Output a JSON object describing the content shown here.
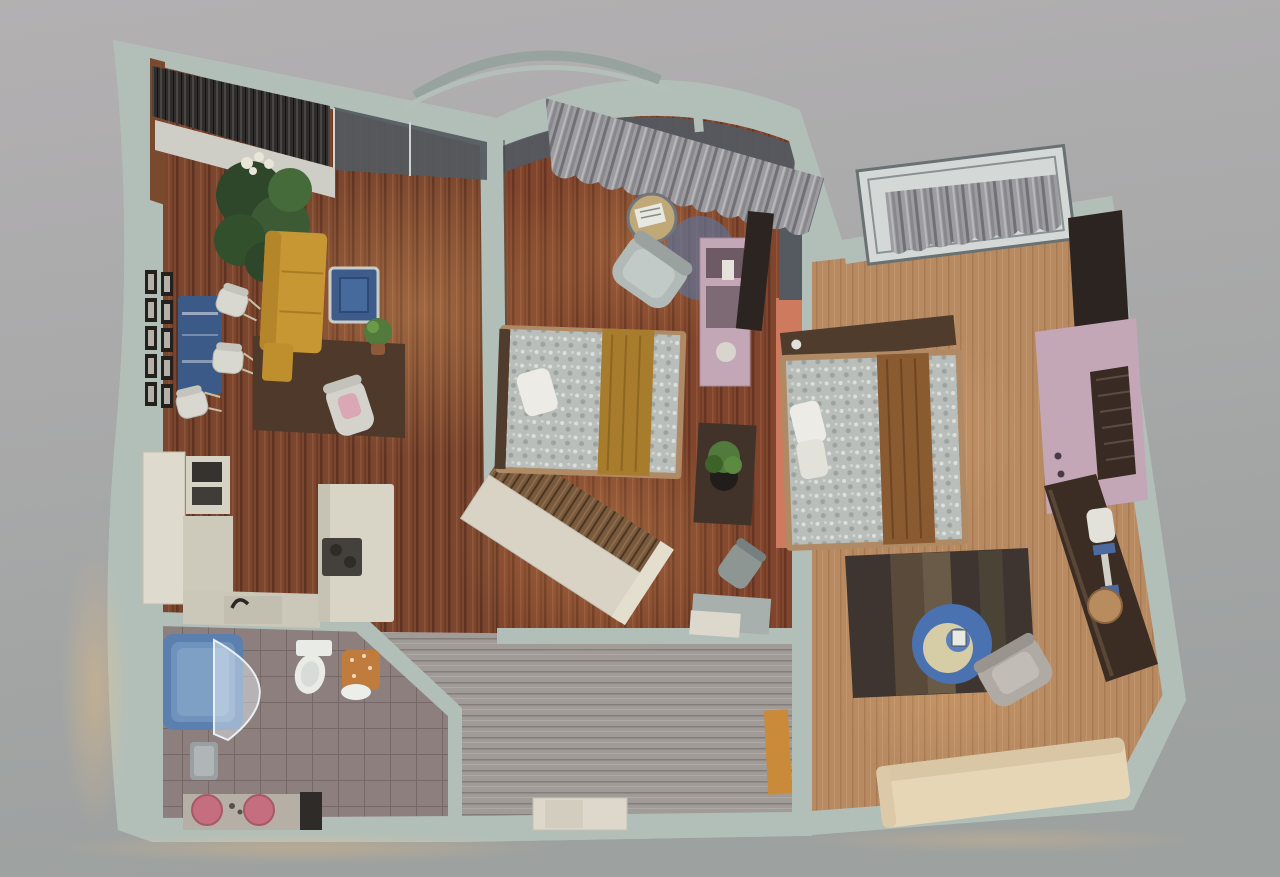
{
  "scene": {
    "kind": "3d-floorplan-top-view",
    "rooms": [
      {
        "id": "living-room",
        "label": "Living room",
        "furniture": [
          "corner window with blinds",
          "window sideboard",
          "large green plant",
          "picture frame wall grid",
          "blue wall table",
          "three white chairs",
          "yellow sofa",
          "dark area rug",
          "blue coffee table",
          "small floor plant",
          "white armchair with pink cushion"
        ]
      },
      {
        "id": "kitchen",
        "label": "Kitchen",
        "furniture": [
          "tall cabinet",
          "oven stack",
          "L-shaped counter",
          "sink with faucet",
          "island with dark cooktop"
        ]
      },
      {
        "id": "bathroom",
        "label": "Bathroom",
        "furniture": [
          "blue bathtub",
          "curved glass screen",
          "toilet",
          "orange laundry basket",
          "towel",
          "vanity with two pink sinks"
        ]
      },
      {
        "id": "entry-hall",
        "label": "Entry hall",
        "furniture": [
          "angled wood-slat wardrobe",
          "white console",
          "amber open door"
        ]
      },
      {
        "id": "bedroom-center",
        "label": "Center bedroom",
        "furniture": [
          "gray curtains",
          "gray armchair",
          "round side table with magazine",
          "double bed with gold runner",
          "dark bench with potted plant",
          "lilac dresser",
          "dark TV panel",
          "desk chair",
          "bench shelf"
        ]
      },
      {
        "id": "bedroom-right",
        "label": "Right bedroom",
        "furniture": [
          "tilted window pane",
          "gray curtains",
          "bed with brown throw",
          "white pillows",
          "lilac TV stand",
          "dark TV panel",
          "speaker grille",
          "long wall console",
          "floor lamp",
          "round stool",
          "striped dark rug",
          "round blue side table",
          "gray armchair",
          "cream sofa"
        ]
      }
    ]
  },
  "colors": {
    "background_top": "#b3b0b2",
    "background_bottom": "#9da1a0",
    "wall": "#b2bfb9",
    "wall_arch_outer": "#97a39e",
    "wall_arch_inner": "#b4bfba",
    "glass": "#545a60",
    "blind_dark": "#2e2c2a",
    "wood_frame_brown": "#7a4a2e",
    "floor_living": "#7b452e",
    "floor_bedroom_right": "#b88a62",
    "floor_entry": "#a09b97",
    "floor_bath": "#8d7f7d",
    "curtain": "#9d9da1",
    "plant_dark": "#2e4629",
    "plant_mid": "#3c5a33",
    "plant_light": "#527a3c",
    "flower_white": "#e8e6d8",
    "frame_black": "#23201e",
    "frame_photo": "#b5b1a8",
    "art_blue": "#3b5a88",
    "chair_white": "#d8d8d0",
    "sofa_yellow": "#c79733",
    "sofa_yellow_dark": "#b5852a",
    "rug_brown": "#4e392b",
    "coffee_table_blue": "#3d5c8c",
    "cabinet_cream": "#dedacd",
    "counter_cream": "#cdc9bb",
    "appliance_dark": "#35322f",
    "cooktop_dark": "#44403c",
    "bathtub_blue": "#5b7fae",
    "bathtub_inner": "#7093bd",
    "toilet_white": "#e9ebe7",
    "basket_orange": "#c07c3c",
    "vanity_top": "#b6afa6",
    "sink_pink": "#c46e80",
    "wardrobe_front": "#d9d3c5",
    "wardrobe_slats": "#7a5a3c",
    "console_white": "#ddd8cb",
    "door_amber": "#c98a3a",
    "bed_linen": "#b9beba",
    "bed_runner_gold": "#a87c2d",
    "bed_throw_brown": "#8a5a30",
    "pillow_white": "#ecebe5",
    "headboard_dark": "#503c2c",
    "bed_frame_tan": "#b08a64",
    "bench_dark": "#41332a",
    "dresser_pink": "#c3a7b6",
    "accent_coral": "#cd7a5e",
    "tv_dark": "#2c2420",
    "armchair_gray": "#b2bab8",
    "armchair_gray2": "#b0aaa4",
    "table_round_blue": "#4a72b0",
    "table_inner_cream": "#d6cda6",
    "lamp_blue": "#4a6aa0",
    "lamp_white": "#e2e2da",
    "stool_tan": "#b98c5f",
    "rug_dark": "#3f3530",
    "sofa_cream": "#e6d6b6",
    "sofa_cream_dark": "#d8c6a4",
    "seat_gray": "#8e9694",
    "bench_gray": "#a8b0ad"
  }
}
